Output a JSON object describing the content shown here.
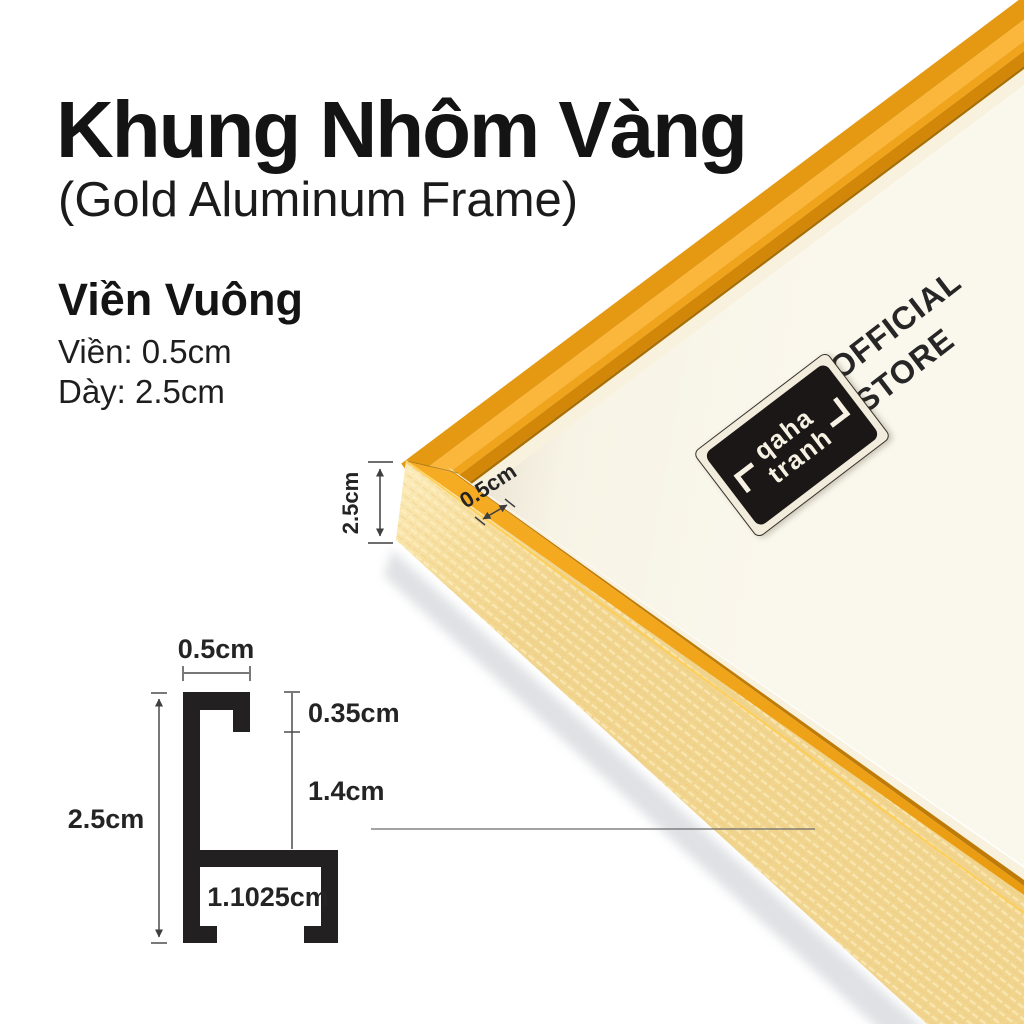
{
  "header": {
    "title": "Khung Nhôm Vàng",
    "subtitle": "(Gold Aluminum Frame)"
  },
  "specs": {
    "heading": "Viền Vuông",
    "border_line": "Viền: 0.5cm",
    "thickness_line": "Dày: 2.5cm"
  },
  "photo": {
    "store_line1": "OFFICIAL",
    "store_line2": "STORE",
    "logo_line1": "qaha",
    "logo_line2": "tranh",
    "thickness_label": "2.5cm",
    "border_label": "0.5cm"
  },
  "profile": {
    "top_width": "0.5cm",
    "lip_depth": "0.35cm",
    "channel_height": "1.4cm",
    "total_thickness": "2.5cm",
    "base_width": "1.1025cm"
  },
  "colors": {
    "frame_gold": "#F2A51D",
    "frame_gold_dark": "#D28708",
    "frame_gold_highlight": "#FBB73C",
    "frame_side_pale": "#F6DFA2",
    "mat_cream": "#F8F4E7",
    "diagram_black": "#232021",
    "text_black": "#1A1A1A"
  }
}
